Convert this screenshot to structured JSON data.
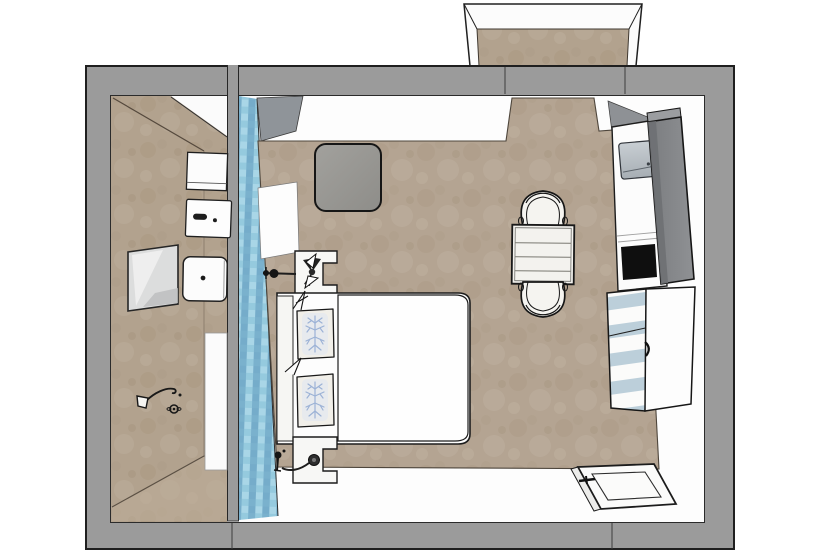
{
  "scene": {
    "description": "Top-down 3D floor plan render of a hotel room with en-suite bathroom, balcony recess, bed with coral-pattern pillows, blue mosaic accent wall, wardrobe, safe, striped dresser, table with two chairs and open entrance door",
    "palette": {
      "wall_gray": "#9b9b9b",
      "outline_black": "#1f1f1f",
      "bedroom_floor_tan": "#b4a492",
      "bathroom_tan": "#b2a28e",
      "accent_wall_blue": "#8fc3da",
      "wardrobe_gray": "#85878a",
      "safe_gray": "#b9c1c8",
      "dresser_stripe_blue": "#bccfda",
      "pillow_motif_blue": "#9cb2d6",
      "furniture_white": "#fbfbfa",
      "niche_black": "#0f0f0f"
    },
    "labels": {
      "floorplan": "Hotel room floor plan",
      "balcony": "Balcony recess",
      "outer_walls": "Outer walls",
      "divider_wall": "Bathroom divider wall",
      "bathroom": "Bathroom",
      "bedroom": "Bedroom",
      "accent_wall": "Blue mosaic accent wall",
      "entry_passage": "Entry passage",
      "wall_cabinet": "Wall cabinet",
      "flush_panel": "Flush panel",
      "mirror": "Mirror",
      "washbasin": "Washbasin",
      "shower_head": "Shower head",
      "shower_tray": "Shower tray",
      "stool": "Ottoman stool",
      "wall_panel": "Wall panel",
      "nightstand_top": "Nightstand",
      "nightstand_bottom": "Nightstand",
      "wall_sconce": "Wall sconce",
      "bed": "Double bed",
      "headboard": "Headboard",
      "pillow": "Pillow",
      "duvet": "Duvet",
      "table": "Table",
      "chair": "Chair",
      "safe": "Safe",
      "shelf_unit": "Shelf unit",
      "minibar_niche": "Minibar niche",
      "wardrobe": "Wardrobe",
      "dresser": "Striped dresser",
      "entrance_door": "Entrance door"
    }
  }
}
